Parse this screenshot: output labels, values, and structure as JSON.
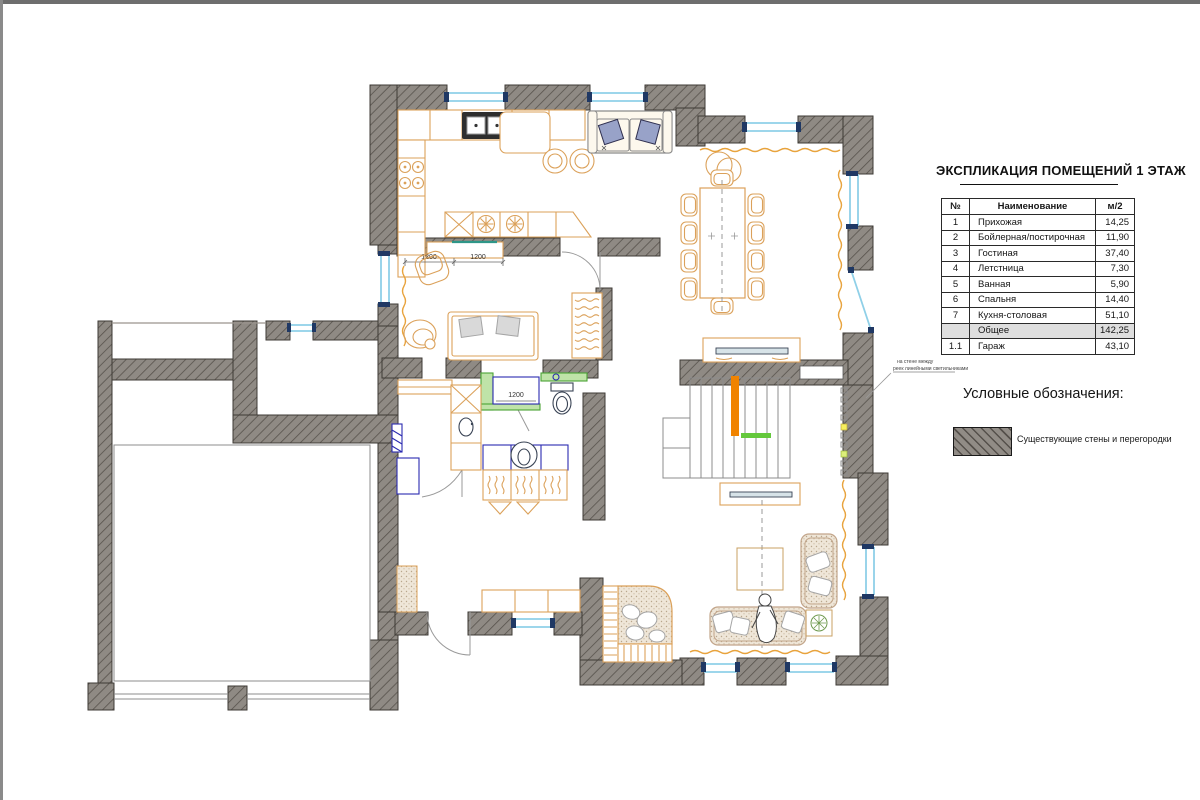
{
  "explication": {
    "title": "ЭКСПЛИКАЦИЯ ПОМЕЩЕНИЙ 1 ЭТАЖ",
    "headers": {
      "num": "№",
      "name": "Наименование",
      "area": "м/2"
    },
    "rows": [
      {
        "num": "1",
        "name": "Прихожая",
        "area": "14,25"
      },
      {
        "num": "2",
        "name": "Бойлерная/постирочная",
        "area": "11,90"
      },
      {
        "num": "3",
        "name": "Гостиная",
        "area": "37,40"
      },
      {
        "num": "4",
        "name": "Летстница",
        "area": "7,30"
      },
      {
        "num": "5",
        "name": "Ванная",
        "area": "5,90"
      },
      {
        "num": "6",
        "name": "Спальня",
        "area": "14,40"
      },
      {
        "num": "7",
        "name": "Кухня-столовая",
        "area": "51,10"
      },
      {
        "num": "",
        "name": "Общее",
        "area": "142,25"
      },
      {
        "num": "1.1",
        "name": "Гараж",
        "area": "43,10"
      }
    ]
  },
  "legend": {
    "title": "Условные обозначения:",
    "items": [
      {
        "label": "Существующие стены и перегородки"
      }
    ]
  },
  "annotation": {
    "line1": "на стене между",
    "line2": "реек линейными светильниками"
  },
  "dimensions": {
    "bedroom_a": "1200",
    "bedroom_b": "1200",
    "shower": "1200"
  },
  "colors": {
    "wall": "#8f8a84",
    "hatch": "#57524c",
    "window": "#8fd0e8",
    "furniture": "#dba15a",
    "fixture": "#2b2bb0",
    "green": "#4aa335",
    "stair_stripe": "#f08300",
    "stair_tread": "#64c83c"
  }
}
